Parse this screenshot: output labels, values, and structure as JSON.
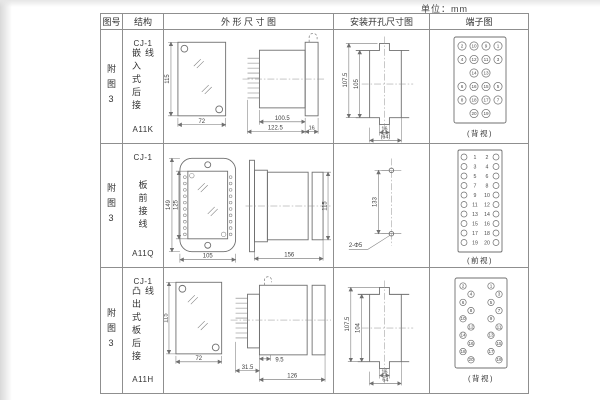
{
  "unit_label": "单位：mm",
  "table_headers": [
    "图号",
    "结构",
    "外 形 尺 寸 图",
    "安装开孔尺寸图",
    "端子图"
  ],
  "rows": [
    {
      "fig_no": "附图3",
      "structure": {
        "model": "CJ-1",
        "desc": "嵌入式后接线",
        "code": "A11K"
      },
      "outline": {
        "front_h": "115",
        "front_w": "72",
        "body_len": "100.5",
        "total_len": "122.5",
        "flange_w": "16"
      },
      "mounting": {
        "outer_h": "107.5",
        "inner_h": "105",
        "notch_w": "16",
        "total_w": "(64)"
      },
      "terminal": {
        "caption": "(背视)",
        "grid": [
          [
            "2",
            "10",
            "9",
            "1"
          ],
          [
            "4",
            "12",
            "11",
            "3"
          ],
          [
            "",
            "14",
            "13",
            ""
          ],
          [
            "6",
            "16",
            "15",
            "5"
          ],
          [
            "8",
            "18",
            "17",
            "7"
          ],
          [
            "",
            "20",
            "19",
            ""
          ]
        ]
      }
    },
    {
      "fig_no": "附图3",
      "structure": {
        "model": "CJ-1",
        "desc": "板前接线",
        "code": "A11Q"
      },
      "outline": {
        "plate_h": "149",
        "window_h": "125",
        "plate_w": "105",
        "side_len": "156",
        "side_h": "115"
      },
      "mounting": {
        "span": "133",
        "holes": "2-Φ5"
      },
      "terminal": {
        "caption": "(前视)",
        "pairs": [
          [
            "1",
            "2"
          ],
          [
            "3",
            "4"
          ],
          [
            "5",
            "6"
          ],
          [
            "7",
            "8"
          ],
          [
            "9",
            "10"
          ],
          [
            "11",
            "12"
          ],
          [
            "13",
            "14"
          ],
          [
            "15",
            "16"
          ],
          [
            "17",
            "18"
          ],
          [
            "19",
            "20"
          ]
        ]
      }
    },
    {
      "fig_no": "附图3",
      "structure": {
        "model": "CJ-1",
        "desc": "凸出式板后接线",
        "code": "A11H"
      },
      "outline": {
        "front_h": "115",
        "front_w": "72",
        "pin_len": "31.5",
        "step": "9.5",
        "body_len": "126"
      },
      "mounting": {
        "outer_h": "107.5",
        "inner_h": "104",
        "notch_w": "16",
        "total_w": "64"
      },
      "terminal": {
        "caption": "(背视)",
        "left": [
          "2",
          "4",
          "6",
          "8",
          "10",
          "12",
          "14",
          "16",
          "18",
          "20"
        ],
        "right": [
          "1",
          "3",
          "5",
          "7",
          "9",
          "11",
          "13",
          "15",
          "17",
          "19"
        ]
      }
    }
  ]
}
